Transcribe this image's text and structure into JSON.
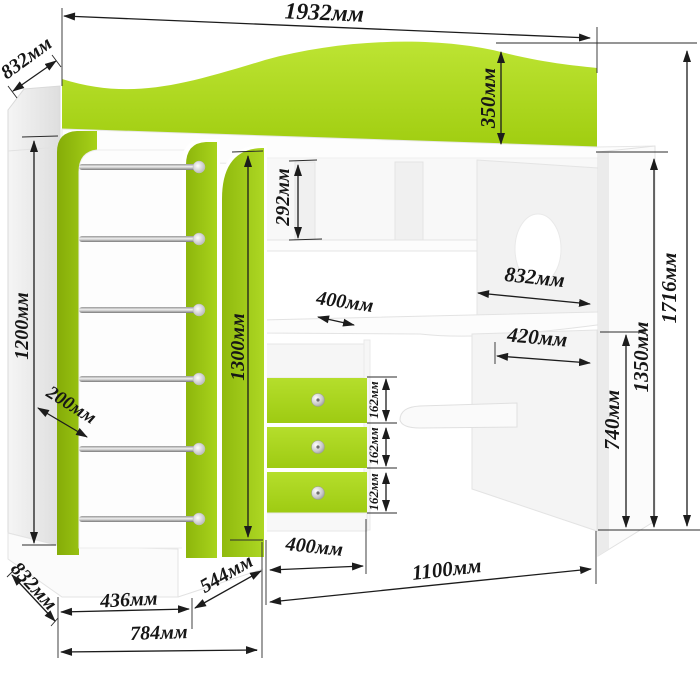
{
  "dims": {
    "total_width": "1932мм",
    "top_depth": "832мм",
    "headboard_height": "350мм",
    "niche_height": "292мм",
    "wardrobe_height": "1200мм",
    "door_depth": "200мм",
    "mid_panel_height": "1300мм",
    "shelf_depth": "400мм",
    "desk_width": "832мм",
    "desk_depth": "420мм",
    "total_height": "1716мм",
    "bed_height": "1350мм",
    "desk_height": "740мм",
    "drawer_1": "162мм",
    "drawer_2": "162мм",
    "drawer_3": "162мм",
    "bottom_diagonal": "544мм",
    "drawer_unit_width": "400мм",
    "desk_section_width": "1100мм",
    "wardrobe_width": "436мм",
    "left_section_width": "784мм",
    "bottom_depth": "832мм"
  },
  "colors": {
    "accent_green": "#a7d31b",
    "dim_line": "#1c1c1c",
    "panel_white": "#fbfbfb"
  }
}
